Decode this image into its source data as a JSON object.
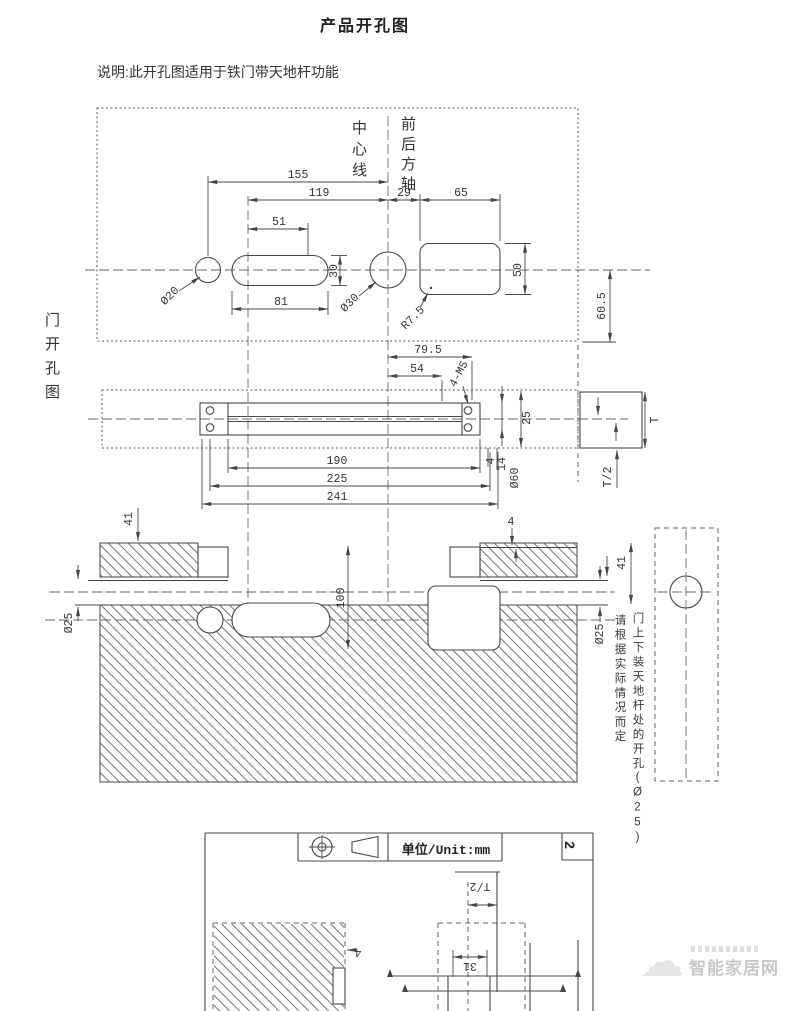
{
  "page": {
    "title": "产品开孔图",
    "note": "说明:此开孔图适用于铁门带天地杆功能",
    "unit_label": "单位/Unit:mm",
    "page_number": "2",
    "watermark": "智能家居网"
  },
  "labels": {
    "door_view": "门开孔图",
    "center_line": "中心线",
    "front_back_axis": "前后方轴",
    "rod_note_1": "门上下装天地杆处的开孔(Ø25)",
    "rod_note_2": "请根据实际情况而定"
  },
  "top_view": {
    "width_155": "155",
    "width_119": "119",
    "width_29": "29",
    "width_65": "65",
    "width_51": "51",
    "width_81": "81",
    "height_30": "30",
    "height_50": "50",
    "height_60_5": "60.5",
    "dia_20": "Ø20",
    "dia_30": "Ø30",
    "radius_7_5": "R7.5"
  },
  "edge_view": {
    "width_79_5": "79.5",
    "width_54": "54",
    "width_190": "190",
    "width_225": "225",
    "width_241": "241",
    "screws": "4-M5",
    "height_25": "25",
    "offset_4": "4",
    "offset_14": "14",
    "dia_60": "Ø60",
    "thickness": "T",
    "half_thickness": "T/2"
  },
  "section_view": {
    "depth_41_left": "41",
    "depth_41_right": "41",
    "offset_4": "4",
    "height_100": "100",
    "dia_25_left": "Ø25",
    "dia_25_right": "Ø25"
  },
  "sheet2": {
    "half_thickness": "T/2",
    "width_31": "31",
    "offset_4": "4"
  }
}
